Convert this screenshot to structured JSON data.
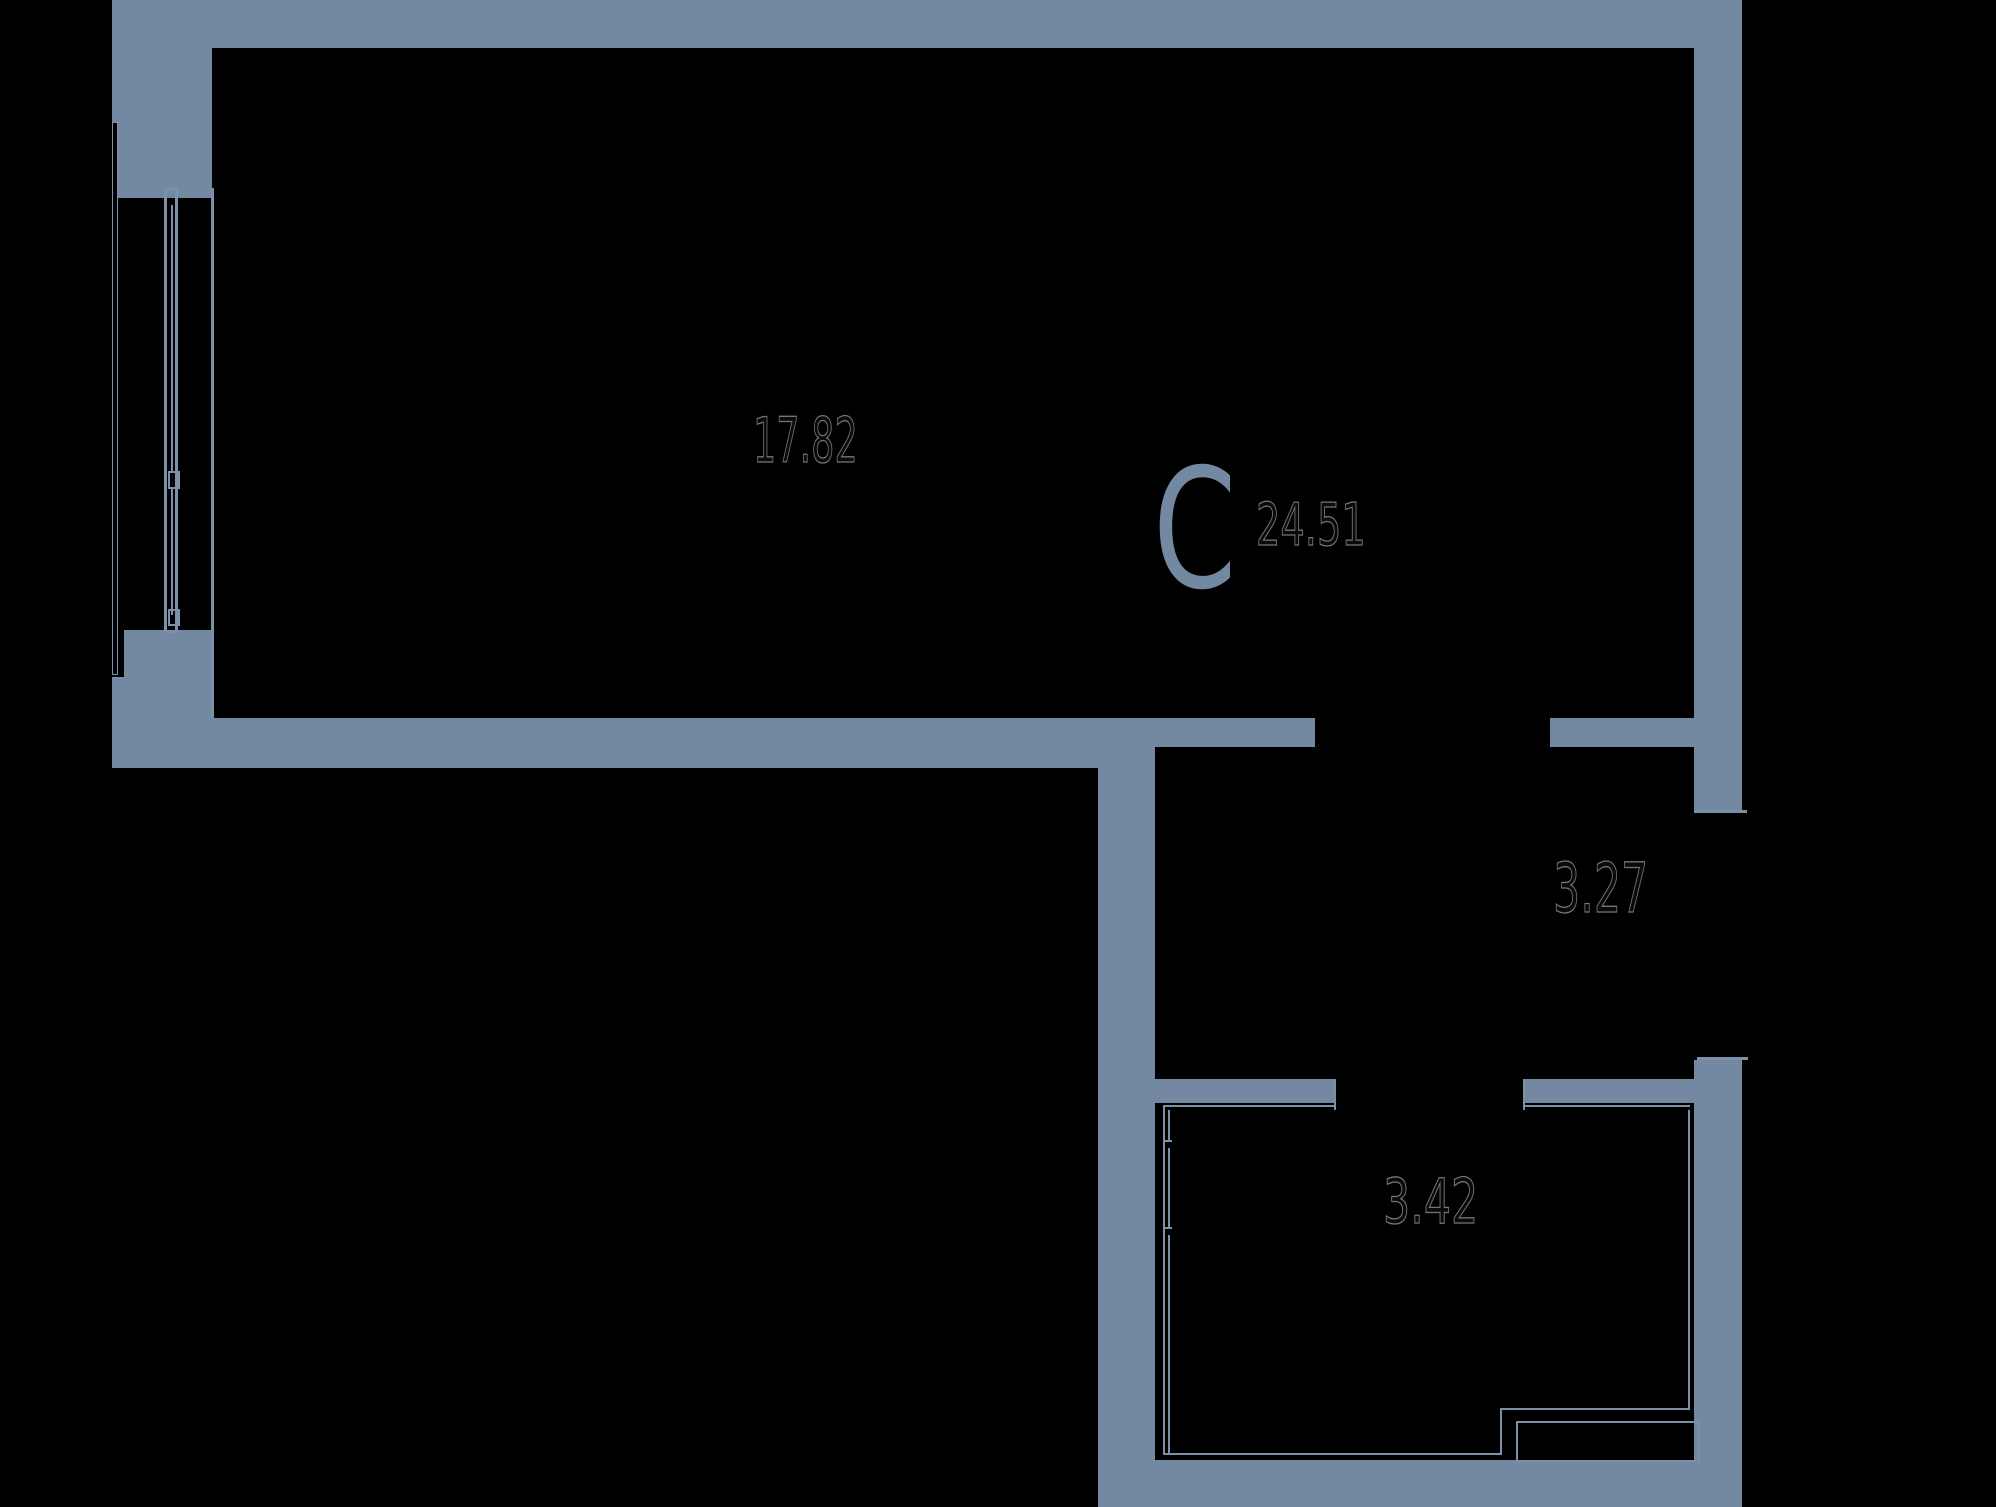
{
  "meta": {
    "canvas_width": 1996,
    "canvas_height": 1507,
    "background_color": "#000000",
    "wall_color": "#7389a2",
    "thin_line_color": "#7c91a9",
    "area_digit_stroke_color": "#72777d",
    "unit_letter_color": "#7389a2"
  },
  "plan": {
    "unit_letter": "С",
    "total_area": "24.51",
    "rooms": [
      {
        "name": "main-room",
        "area": "17.82"
      },
      {
        "name": "hall",
        "area": "3.27"
      },
      {
        "name": "bathroom",
        "area": "3.42"
      }
    ]
  },
  "walls": [
    {
      "name": "wall-top",
      "x": 112,
      "y": 0,
      "w": 1630,
      "h": 48
    },
    {
      "name": "wall-left-upper",
      "x": 112,
      "y": 48,
      "w": 100,
      "h": 74
    },
    {
      "name": "wall-left-window-head",
      "x": 117,
      "y": 122,
      "w": 95,
      "h": 76
    },
    {
      "name": "wall-right-upper",
      "x": 1694,
      "y": 48,
      "w": 48,
      "h": 762
    },
    {
      "name": "wall-left-pier-upper",
      "x": 124,
      "y": 630,
      "w": 88,
      "h": 47
    },
    {
      "name": "wall-left-pier-lower",
      "x": 112,
      "y": 677,
      "w": 100,
      "h": 41
    },
    {
      "name": "wall-bottom-main",
      "x": 112,
      "y": 718,
      "w": 1043,
      "h": 50
    },
    {
      "name": "wall-mid-left",
      "x": 1155,
      "y": 718,
      "w": 160,
      "h": 29
    },
    {
      "name": "wall-mid-right",
      "x": 1550,
      "y": 718,
      "w": 144,
      "h": 29
    },
    {
      "name": "wall-vertical-inner",
      "x": 1098,
      "y": 747,
      "w": 57,
      "h": 713
    },
    {
      "name": "wall-bath-top-left",
      "x": 1155,
      "y": 1079,
      "w": 180,
      "h": 24
    },
    {
      "name": "wall-bath-top-right",
      "x": 1523,
      "y": 1079,
      "w": 171,
      "h": 24
    },
    {
      "name": "wall-right-lower",
      "x": 1694,
      "y": 1060,
      "w": 48,
      "h": 447
    },
    {
      "name": "wall-bottom-right",
      "x": 1098,
      "y": 1460,
      "w": 644,
      "h": 47
    }
  ],
  "lines": [
    {
      "name": "line-main-room-left-edge",
      "x": 211,
      "y": 188,
      "w": 3,
      "h": 530
    },
    {
      "name": "line-window-left-frame",
      "x": 164,
      "y": 188,
      "w": 3,
      "h": 445
    },
    {
      "name": "line-window-right-frame",
      "x": 175,
      "y": 188,
      "w": 3,
      "h": 445
    },
    {
      "name": "line-window-top-cap",
      "x": 164,
      "y": 188,
      "w": 14,
      "h": 3
    },
    {
      "name": "line-window-bottom-cap",
      "x": 164,
      "y": 630,
      "w": 14,
      "h": 3
    },
    {
      "name": "line-window-casement-upper",
      "x": 171,
      "y": 205,
      "w": 2,
      "h": 268
    },
    {
      "name": "line-window-casement-lower",
      "x": 171,
      "y": 489,
      "w": 2,
      "h": 126
    },
    {
      "name": "line-threshold-entry-top",
      "x": 1694,
      "y": 810,
      "w": 53,
      "h": 3
    },
    {
      "name": "line-threshold-entry-bottom",
      "x": 1697,
      "y": 1057,
      "w": 51,
      "h": 3
    },
    {
      "name": "line-bath-jamb-left",
      "x": 1334,
      "y": 1079,
      "w": 2,
      "h": 31
    },
    {
      "name": "line-bath-jamb-right",
      "x": 1523,
      "y": 1079,
      "w": 2,
      "h": 31
    },
    {
      "name": "line-bath-outline-top-a",
      "x": 1163,
      "y": 1105,
      "w": 172,
      "h": 2
    },
    {
      "name": "line-bath-outline-top-b",
      "x": 1523,
      "y": 1105,
      "w": 167,
      "h": 2
    },
    {
      "name": "line-bath-outline-left",
      "x": 1163,
      "y": 1105,
      "w": 2,
      "h": 350
    },
    {
      "name": "line-bath-outline-left-in-1",
      "x": 1168,
      "y": 1110,
      "w": 2,
      "h": 30
    },
    {
      "name": "line-bath-outline-left-in-2",
      "x": 1168,
      "y": 1148,
      "w": 2,
      "h": 79
    },
    {
      "name": "line-bath-outline-left-in-3",
      "x": 1168,
      "y": 1235,
      "w": 2,
      "h": 220
    },
    {
      "name": "tick-bath-door-top",
      "x": 1163,
      "y": 1140,
      "w": 9,
      "h": 2
    },
    {
      "name": "tick-bath-door-bottom",
      "x": 1163,
      "y": 1227,
      "w": 9,
      "h": 2
    },
    {
      "name": "line-bath-outline-right",
      "x": 1688,
      "y": 1110,
      "w": 2,
      "h": 300
    },
    {
      "name": "line-bath-outline-bottom",
      "x": 1165,
      "y": 1453,
      "w": 337,
      "h": 2
    },
    {
      "name": "line-bath-step-vertical",
      "x": 1500,
      "y": 1408,
      "w": 2,
      "h": 47
    },
    {
      "name": "line-bath-step-horizontal",
      "x": 1500,
      "y": 1408,
      "w": 190,
      "h": 2
    }
  ],
  "outline_boxes": [
    {
      "name": "box-window-sill",
      "x": 112,
      "y": 122,
      "w": 6,
      "h": 553,
      "border": 1.5
    },
    {
      "name": "box-window-midpost",
      "x": 168,
      "y": 471,
      "w": 12,
      "h": 18,
      "border": 2
    },
    {
      "name": "box-window-bottom",
      "x": 168,
      "y": 609,
      "w": 12,
      "h": 17,
      "border": 2
    },
    {
      "name": "box-duct-shaft",
      "x": 1516,
      "y": 1421,
      "w": 184,
      "h": 41,
      "border": 2
    }
  ],
  "labels": [
    {
      "name": "label-area-main-room",
      "text": "17.82",
      "x": 753,
      "y": 410,
      "size": 62,
      "scale_x": 0.59,
      "style": "outline"
    },
    {
      "name": "label-unit-letter",
      "text": "С",
      "x": 1153,
      "y": 448,
      "size": 166,
      "scale_x": 0.72,
      "style": "solid"
    },
    {
      "name": "label-area-total",
      "text": "24.51",
      "x": 1256,
      "y": 495,
      "size": 59,
      "scale_x": 0.65,
      "style": "outline"
    },
    {
      "name": "label-area-hall",
      "text": "3.27",
      "x": 1553,
      "y": 855,
      "size": 69,
      "scale_x": 0.62,
      "style": "outline"
    },
    {
      "name": "label-area-bathroom",
      "text": "3.42",
      "x": 1383,
      "y": 1171,
      "size": 62,
      "scale_x": 0.69,
      "style": "outline"
    }
  ]
}
